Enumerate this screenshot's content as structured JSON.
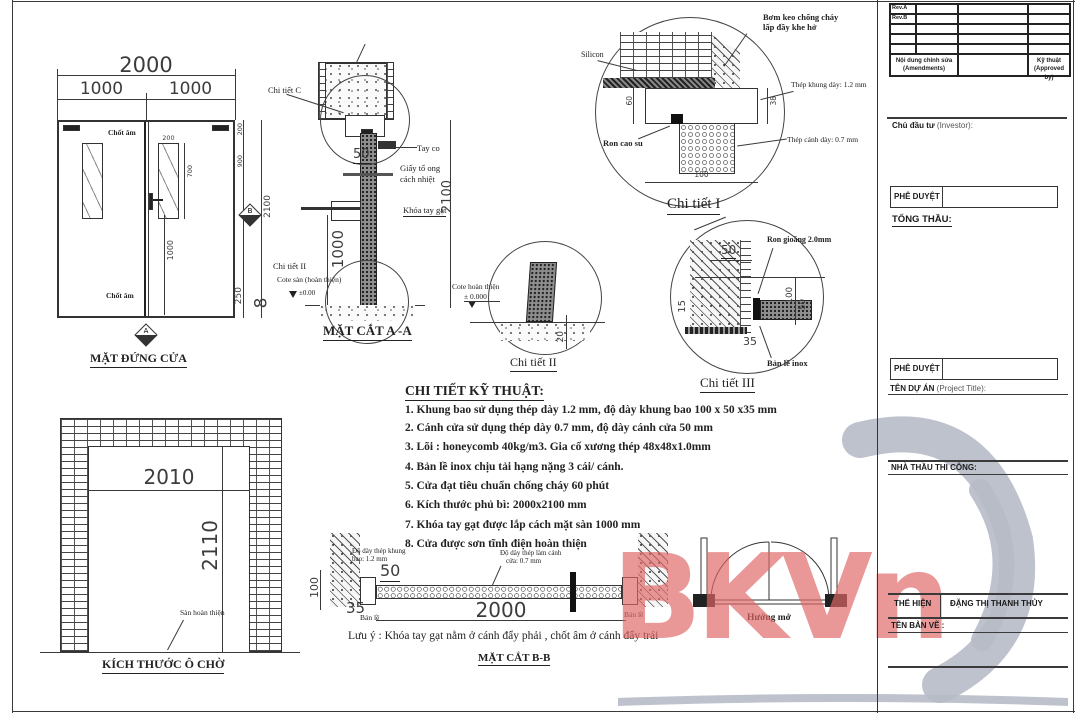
{
  "sheet": {
    "watermark_text": "BKVn",
    "watermark_color": "#e06666",
    "swoosh_color": "#b7bbc7"
  },
  "elevation": {
    "title": "MẶT ĐỨNG CỬA",
    "dim_total": "2000",
    "dim_left_leaf": "1000",
    "dim_right_leaf": "1000",
    "dim_glass_w": "200",
    "dim_glass_h": "700",
    "dim_handle": "1000",
    "dim_top": "200",
    "dim_upper": "900",
    "dim_height": "2100",
    "dim_bottom_rail": "250",
    "dim_gap": "8",
    "label_top_bolt": "Chốt âm",
    "label_bottom_bolt": "Chốt âm",
    "marker_a": "A",
    "marker_b": "B"
  },
  "section_aa": {
    "title": "MẶT CẮT A -A",
    "label_detail_c": "Chi tiết C",
    "label_tay_co": "Tay co",
    "dim_50": "50",
    "label_core_1": "Giấy tổ ong",
    "label_core_2": "cách nhiệt",
    "dim_2100": "2100",
    "label_lock": "Khóa tay gạt",
    "dim_1000": "1000",
    "label_detail_2": "Chi tiết II",
    "label_cote": "Cote sàn (hoàn thiện)",
    "label_level": "±0.00"
  },
  "detail1": {
    "title": "Chi tiết I",
    "label_silicon": "Silicon",
    "label_grout_1": "Bơm keo chống cháy",
    "label_grout_2": "lấp đầy khe hở",
    "label_frame_steel": "Thép khung dày: 1.2 mm",
    "label_leaf_steel": "Thép cánh dày: 0.7 mm",
    "label_gasket": "Ron cao su",
    "dim_60": "60",
    "dim_38": "38",
    "dim_100": "100"
  },
  "detail2": {
    "title": "Chi tiết II",
    "label_cote_1": "Cote hoàn thiện",
    "label_cote_2": "± 0.000",
    "dim_20": "20"
  },
  "detail3": {
    "title": "Chi tiết III",
    "label_gasket": "Ron gioăng 2.0mm",
    "label_hinge": "Bản lề inox",
    "dim_50_top": "50",
    "dim_15": "15",
    "dim_35": "35",
    "dim_100": "100",
    "dim_50_right": "50"
  },
  "specs": {
    "title": "CHI TIẾT KỸ THUẬT:",
    "items": [
      "1. Khung bao sử dụng thép dày 1.2 mm, độ dày khung bao 100 x 50 x35 mm",
      "2. Cánh cửa sử dụng thép dày 0.7 mm, độ dày cánh cửa 50 mm",
      "3. Lõi : honeycomb 40kg/m3. Gia cố xương thép 48x48x1.0mm",
      "4. Bản lề inox chịu tải hạng nặng 3 cái/ cánh.",
      "5. Cửa đạt tiêu chuẩn chống cháy 60 phút",
      "6. Kích thước phủ bì: 2000x2100 mm",
      "7. Khóa tay gạt được lắp cách mặt sàn 1000 mm",
      "8. Cửa được sơn tĩnh điện hoàn thiện"
    ]
  },
  "opening": {
    "title": "KÍCH THƯỚC Ô CHỜ",
    "dim_width": "2010",
    "dim_height": "2110",
    "label_floor": "Sàn hoàn thiện"
  },
  "section_bb": {
    "title": "MẶT CẮT B-B",
    "label_frame_1": "Độ dày thép khung",
    "label_frame_2": "bao: 1.2 mm",
    "label_leaf_1": "Độ dày thép làm cánh",
    "label_leaf_2": "cửa: 0.7 mm",
    "dim_50": "50",
    "dim_35": "35",
    "dim_100": "100",
    "dim_2000": "2000",
    "label_hinge_left": "Bản lề",
    "label_hinge_right": "Bản lề",
    "note": "Lưu ý : Khóa tay gạt nằm ở cánh đẩy phải , chốt âm ở cánh đẩy trái"
  },
  "swing": {
    "label": "Hướng mở"
  },
  "titleblock": {
    "rev_a": "Rev.A",
    "rev_b": "Rev.B",
    "amendments": "Nội dung chỉnh sửa (Amendments)",
    "approved": "Kỹ thuật (Approved by)",
    "investor_bold": "Chủ đầu tư",
    "investor_normal": "(Investor):",
    "approve1": "PHÊ DUYỆT",
    "tong_thau": "TỔNG THẦU:",
    "approve2": "PHÊ DUYỆT",
    "project_bold": "TÊN DỰ ÁN",
    "project_normal": "(Project Title):",
    "contractor": "NHÀ THẦU THI CÔNG:",
    "the_hien": "THỂ HIỆN",
    "drafter": "ĐẶNG THỊ THANH THỦY",
    "ten_ban_ve": "TÊN BẢN VẼ :"
  }
}
